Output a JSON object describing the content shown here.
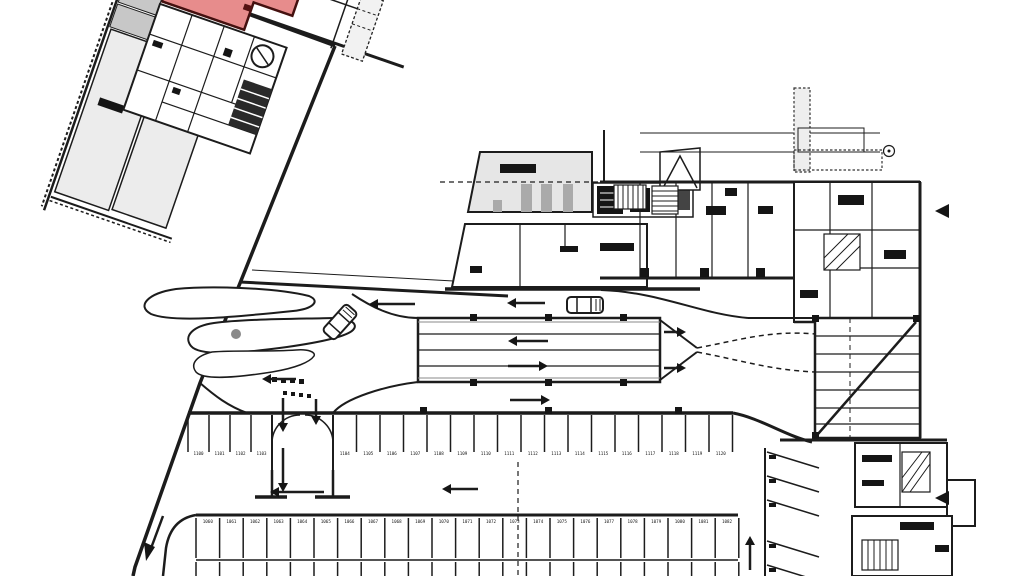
{
  "plan": {
    "kind": "architectural floor plan - parking level with highlighted unit",
    "background": "#ffffff",
    "line_color": "#1c1c1c",
    "highlighted_room": {
      "fill": "#e78c8c",
      "stroke": "#44100f",
      "position": "top-center of tilted wing"
    },
    "room_fills": {
      "light_gray": "#ececec",
      "mid_gray": "#c7c7c7",
      "pale_gray": "#e6e6e6"
    },
    "parking": {
      "middle_row": {
        "first_number": 1100,
        "top_y": 415,
        "depth": 37,
        "number_y": 455,
        "sections": [
          {
            "x0": 188,
            "count": 4,
            "stall_width": 21
          },
          {
            "x0": 333,
            "count": 17,
            "stall_width": 23.5
          }
        ]
      },
      "bottom_row": {
        "first_number": 1060,
        "x0": 196,
        "count": 23,
        "stall_width": 23.6,
        "top_y": 518,
        "depth": 40,
        "number_y": 523,
        "second_tier_y": 562,
        "bottom_cut": 576
      },
      "angled_column": {
        "x": 765,
        "run": 52,
        "drop": 16,
        "lines_upper": [
          452,
          476,
          500
        ],
        "lines_lower": [
          541,
          565
        ]
      }
    },
    "arrows": [
      {
        "x": 415,
        "y": 304,
        "dir": "left",
        "len": 46
      },
      {
        "x": 545,
        "y": 303,
        "dir": "left",
        "len": 38
      },
      {
        "x": 296,
        "y": 379,
        "dir": "left",
        "len": 34
      },
      {
        "x": 548,
        "y": 341,
        "dir": "left",
        "len": 40
      },
      {
        "x": 508,
        "y": 366,
        "dir": "right",
        "len": 40
      },
      {
        "x": 510,
        "y": 400,
        "dir": "right",
        "len": 40
      },
      {
        "x": 478,
        "y": 489,
        "dir": "left",
        "len": 36
      },
      {
        "x": 283,
        "y": 398,
        "dir": "down",
        "len": 34
      },
      {
        "x": 316,
        "y": 399,
        "dir": "down",
        "len": 26
      },
      {
        "x": 283,
        "y": 448,
        "dir": "down",
        "len": 44
      },
      {
        "x": 324,
        "y": 492,
        "dir": "left",
        "len": 54
      },
      {
        "x": 750,
        "y": 570,
        "dir": "up",
        "len": 34
      },
      {
        "x": 664,
        "y": 332,
        "dir": "right",
        "len": 22
      },
      {
        "x": 664,
        "y": 368,
        "dir": "right",
        "len": 22
      }
    ],
    "cars": [
      {
        "x": 340,
        "y": 322,
        "angle": -48
      },
      {
        "x": 585,
        "y": 305,
        "angle": 0
      }
    ],
    "wall_markers": [
      {
        "x": 941,
        "y": 211,
        "dir": "left"
      },
      {
        "x": 941,
        "y": 498,
        "dir": "left"
      }
    ],
    "column_marker": {
      "x": 889,
      "y": 151,
      "r": 5.5
    }
  }
}
